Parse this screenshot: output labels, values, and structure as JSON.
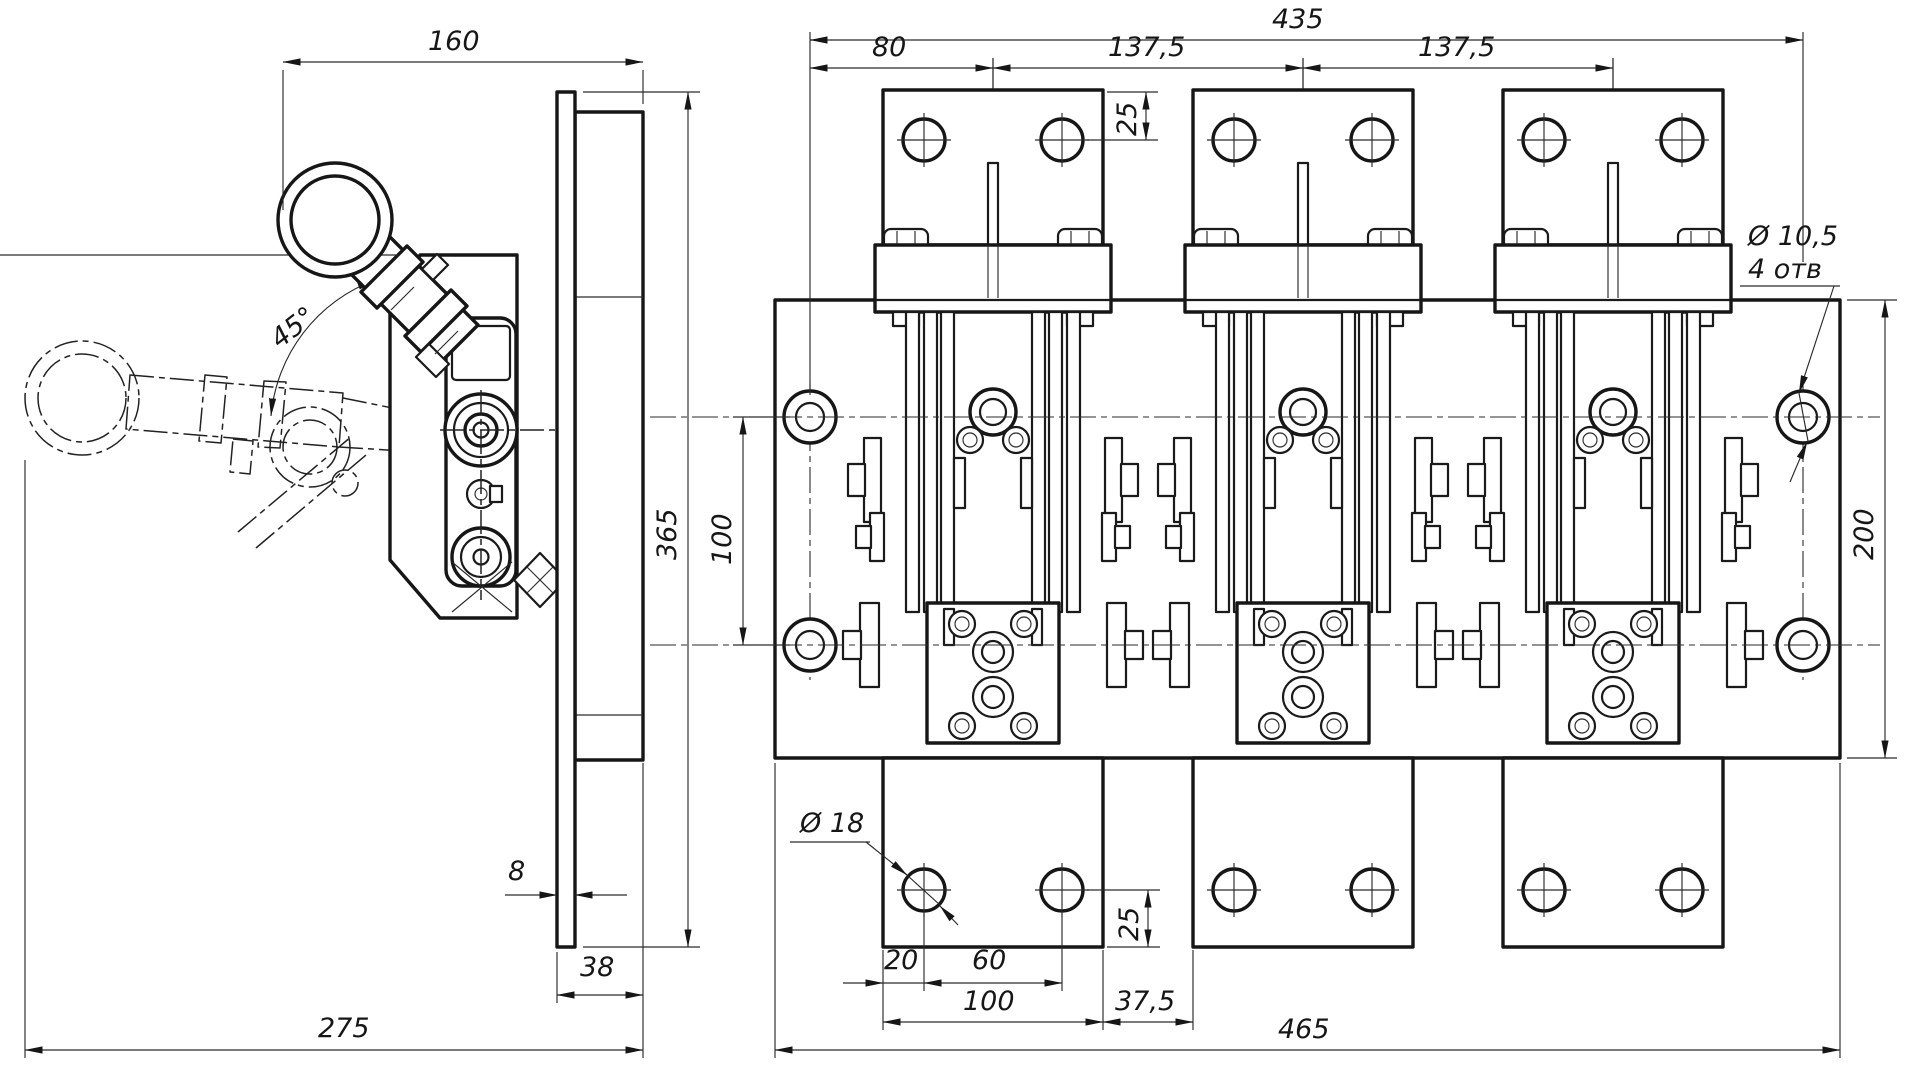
{
  "drawing": {
    "type": "engineering-technical-drawing",
    "subject": "three-pole knife switch / disconnector, two orthographic views",
    "side_view": {
      "label": "side view with operating handle",
      "dim_width_top": "160",
      "dim_angle": "45°",
      "dim_height": "365",
      "dim_plate_thickness": "8",
      "dim_block_depth": "38",
      "dim_overall_depth": "275"
    },
    "front_view": {
      "label": "front view, three poles on mounting panel",
      "dim_overall_top": "435",
      "dim_pole_offset": "80",
      "dim_pole_pitch_left": "137,5",
      "dim_pole_pitch_right": "137,5",
      "dim_tab_hole_top": "25",
      "dim_mount_hole_dia": "Ø 10,5",
      "dim_mount_hole_count": "4 отв",
      "dim_mount_hole_spacing": "100",
      "dim_panel_height": "200",
      "dim_tab_hole_dia": "Ø 18",
      "dim_hole_edge_offset": "20",
      "dim_hole_spacing": "60",
      "dim_tab_width": "100",
      "dim_tab_gap": "37,5",
      "dim_tab_hole_bottom": "25",
      "dim_panel_width": "465"
    }
  }
}
